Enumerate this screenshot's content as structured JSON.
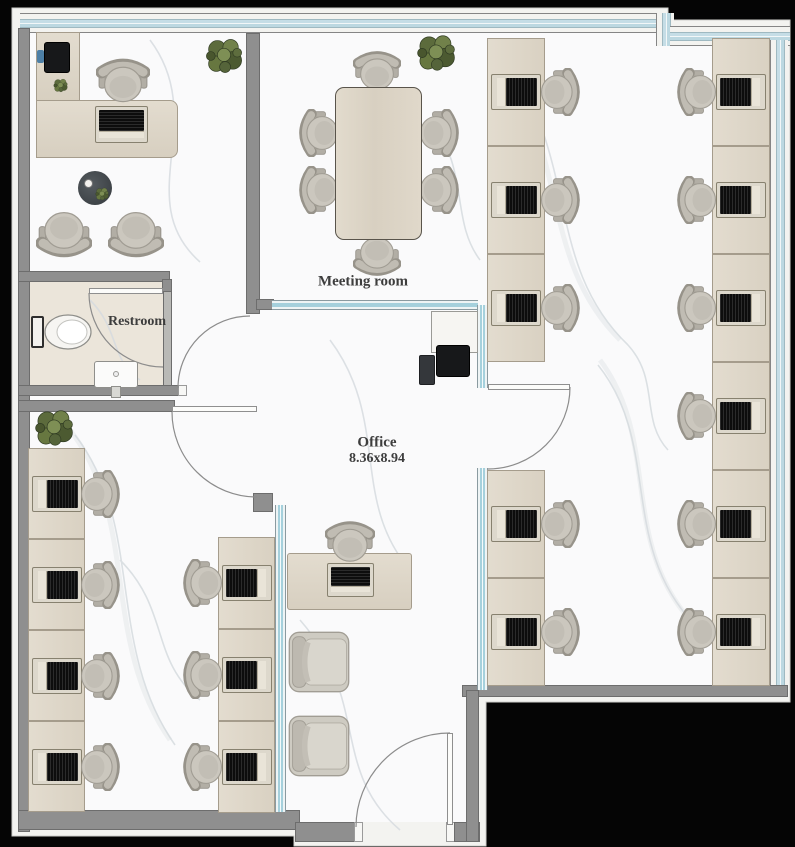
{
  "plan": {
    "width": 795,
    "height": 847,
    "labels": {
      "meeting_room": "Meeting room",
      "restroom": "Restroom",
      "office_name": "Office",
      "office_dimensions": "8.36x8.94"
    },
    "rooms": [
      "Meeting room",
      "Restroom",
      "Office 8.36x8.94",
      "Executive office",
      "Open office right wing",
      "Open office left wing",
      "Lounge"
    ],
    "colors": {
      "outside": "#050505",
      "boundary_white": "#f3f3f0",
      "wall_gray": "#8f8f8f",
      "glazing_teal": "#aed4df",
      "floor_marble": "#fafafb",
      "floor_restroom": "#ebe5da",
      "desk_wood": "#ddd5c7",
      "chair_fabric": "#c8c4ba",
      "label_text": "#3d3d3d"
    }
  },
  "furniture": {
    "workstation_columns": [
      {
        "name": "right-office-west-column-upper",
        "x": 487,
        "y": 38,
        "w": 58,
        "rowH": 108,
        "rows": 3,
        "chair": "right"
      },
      {
        "name": "right-office-west-column-lower",
        "x": 487,
        "y": 470,
        "w": 58,
        "rowH": 108,
        "rows": 2,
        "chair": "right"
      },
      {
        "name": "right-office-east-column",
        "x": 712,
        "y": 38,
        "w": 58,
        "rowH": 108,
        "rows": 6,
        "chair": "left"
      },
      {
        "name": "left-office-west-column",
        "x": 28,
        "y": 448,
        "w": 57,
        "rowH": 91,
        "rows": 4,
        "chair": "right"
      },
      {
        "name": "left-office-middle-column",
        "x": 218,
        "y": 537,
        "w": 57,
        "rowH": 92,
        "rows": 3,
        "chair": "left"
      }
    ],
    "center_workstation": {
      "desk": {
        "x": 287,
        "y": 553,
        "w": 125,
        "h": 57
      },
      "chair": {
        "cx": 350,
        "cy": 543,
        "facing": "down"
      },
      "laptop": {
        "x": 327,
        "y": 563,
        "w": 47,
        "h": 34
      }
    },
    "executive_office": {
      "return_desk": {
        "x": 36,
        "y": 32,
        "w": 44,
        "h": 70
      },
      "main_desk": {
        "x": 36,
        "y": 100,
        "w": 142,
        "h": 58
      },
      "laptop": {
        "x": 95,
        "y": 106,
        "w": 53,
        "h": 37
      },
      "chair": {
        "cx": 123,
        "cy": 82,
        "facing": "down"
      },
      "printer": {
        "x": 44,
        "y": 42,
        "w": 26,
        "h": 31
      },
      "blue_item": {
        "x": 37,
        "y": 50,
        "w": 7,
        "h": 13
      },
      "desk_plant": {
        "cx": 60,
        "cy": 85,
        "s": 17
      },
      "coffee_table": {
        "cx": 95,
        "cy": 188,
        "r": 17
      },
      "guest_chairs": [
        {
          "cx": 64,
          "cy": 233,
          "facing": "up"
        },
        {
          "cx": 136,
          "cy": 233,
          "facing": "up"
        }
      ]
    },
    "meeting_room": {
      "table": {
        "x": 335,
        "y": 87,
        "w": 87,
        "h": 153
      },
      "chairs": [
        {
          "cx": 377,
          "cy": 72,
          "facing": "down"
        },
        {
          "cx": 377,
          "cy": 255,
          "facing": "up"
        },
        {
          "cx": 320,
          "cy": 133,
          "facing": "right"
        },
        {
          "cx": 320,
          "cy": 190,
          "facing": "right"
        },
        {
          "cx": 438,
          "cy": 133,
          "facing": "left"
        },
        {
          "cx": 438,
          "cy": 190,
          "facing": "left"
        }
      ]
    },
    "lounge_chairs": [
      {
        "x": 286,
        "y": 627,
        "w": 66,
        "h": 70,
        "facing": "right"
      },
      {
        "x": 286,
        "y": 711,
        "w": 66,
        "h": 70,
        "facing": "right"
      }
    ],
    "plants": [
      {
        "name": "plant-exec-corner",
        "cx": 224,
        "cy": 56,
        "s": 44
      },
      {
        "name": "plant-meeting-corner",
        "cx": 436,
        "cy": 53,
        "s": 46
      },
      {
        "name": "plant-left-office",
        "cx": 54,
        "cy": 428,
        "s": 46
      }
    ],
    "restroom_fixtures": {
      "toilet": {
        "x": 31,
        "y": 313,
        "tank_w": 13,
        "bowl_w": 44,
        "h": 38
      },
      "sink": {
        "x": 94,
        "y": 361,
        "w": 44,
        "h": 27
      }
    },
    "copier_station": {
      "cabinet": {
        "x": 431,
        "y": 311,
        "w": 47,
        "h": 42
      },
      "printer": {
        "x": 436,
        "y": 345,
        "w": 34,
        "h": 32
      },
      "side_unit": {
        "x": 419,
        "y": 355,
        "w": 16,
        "h": 30
      }
    }
  }
}
